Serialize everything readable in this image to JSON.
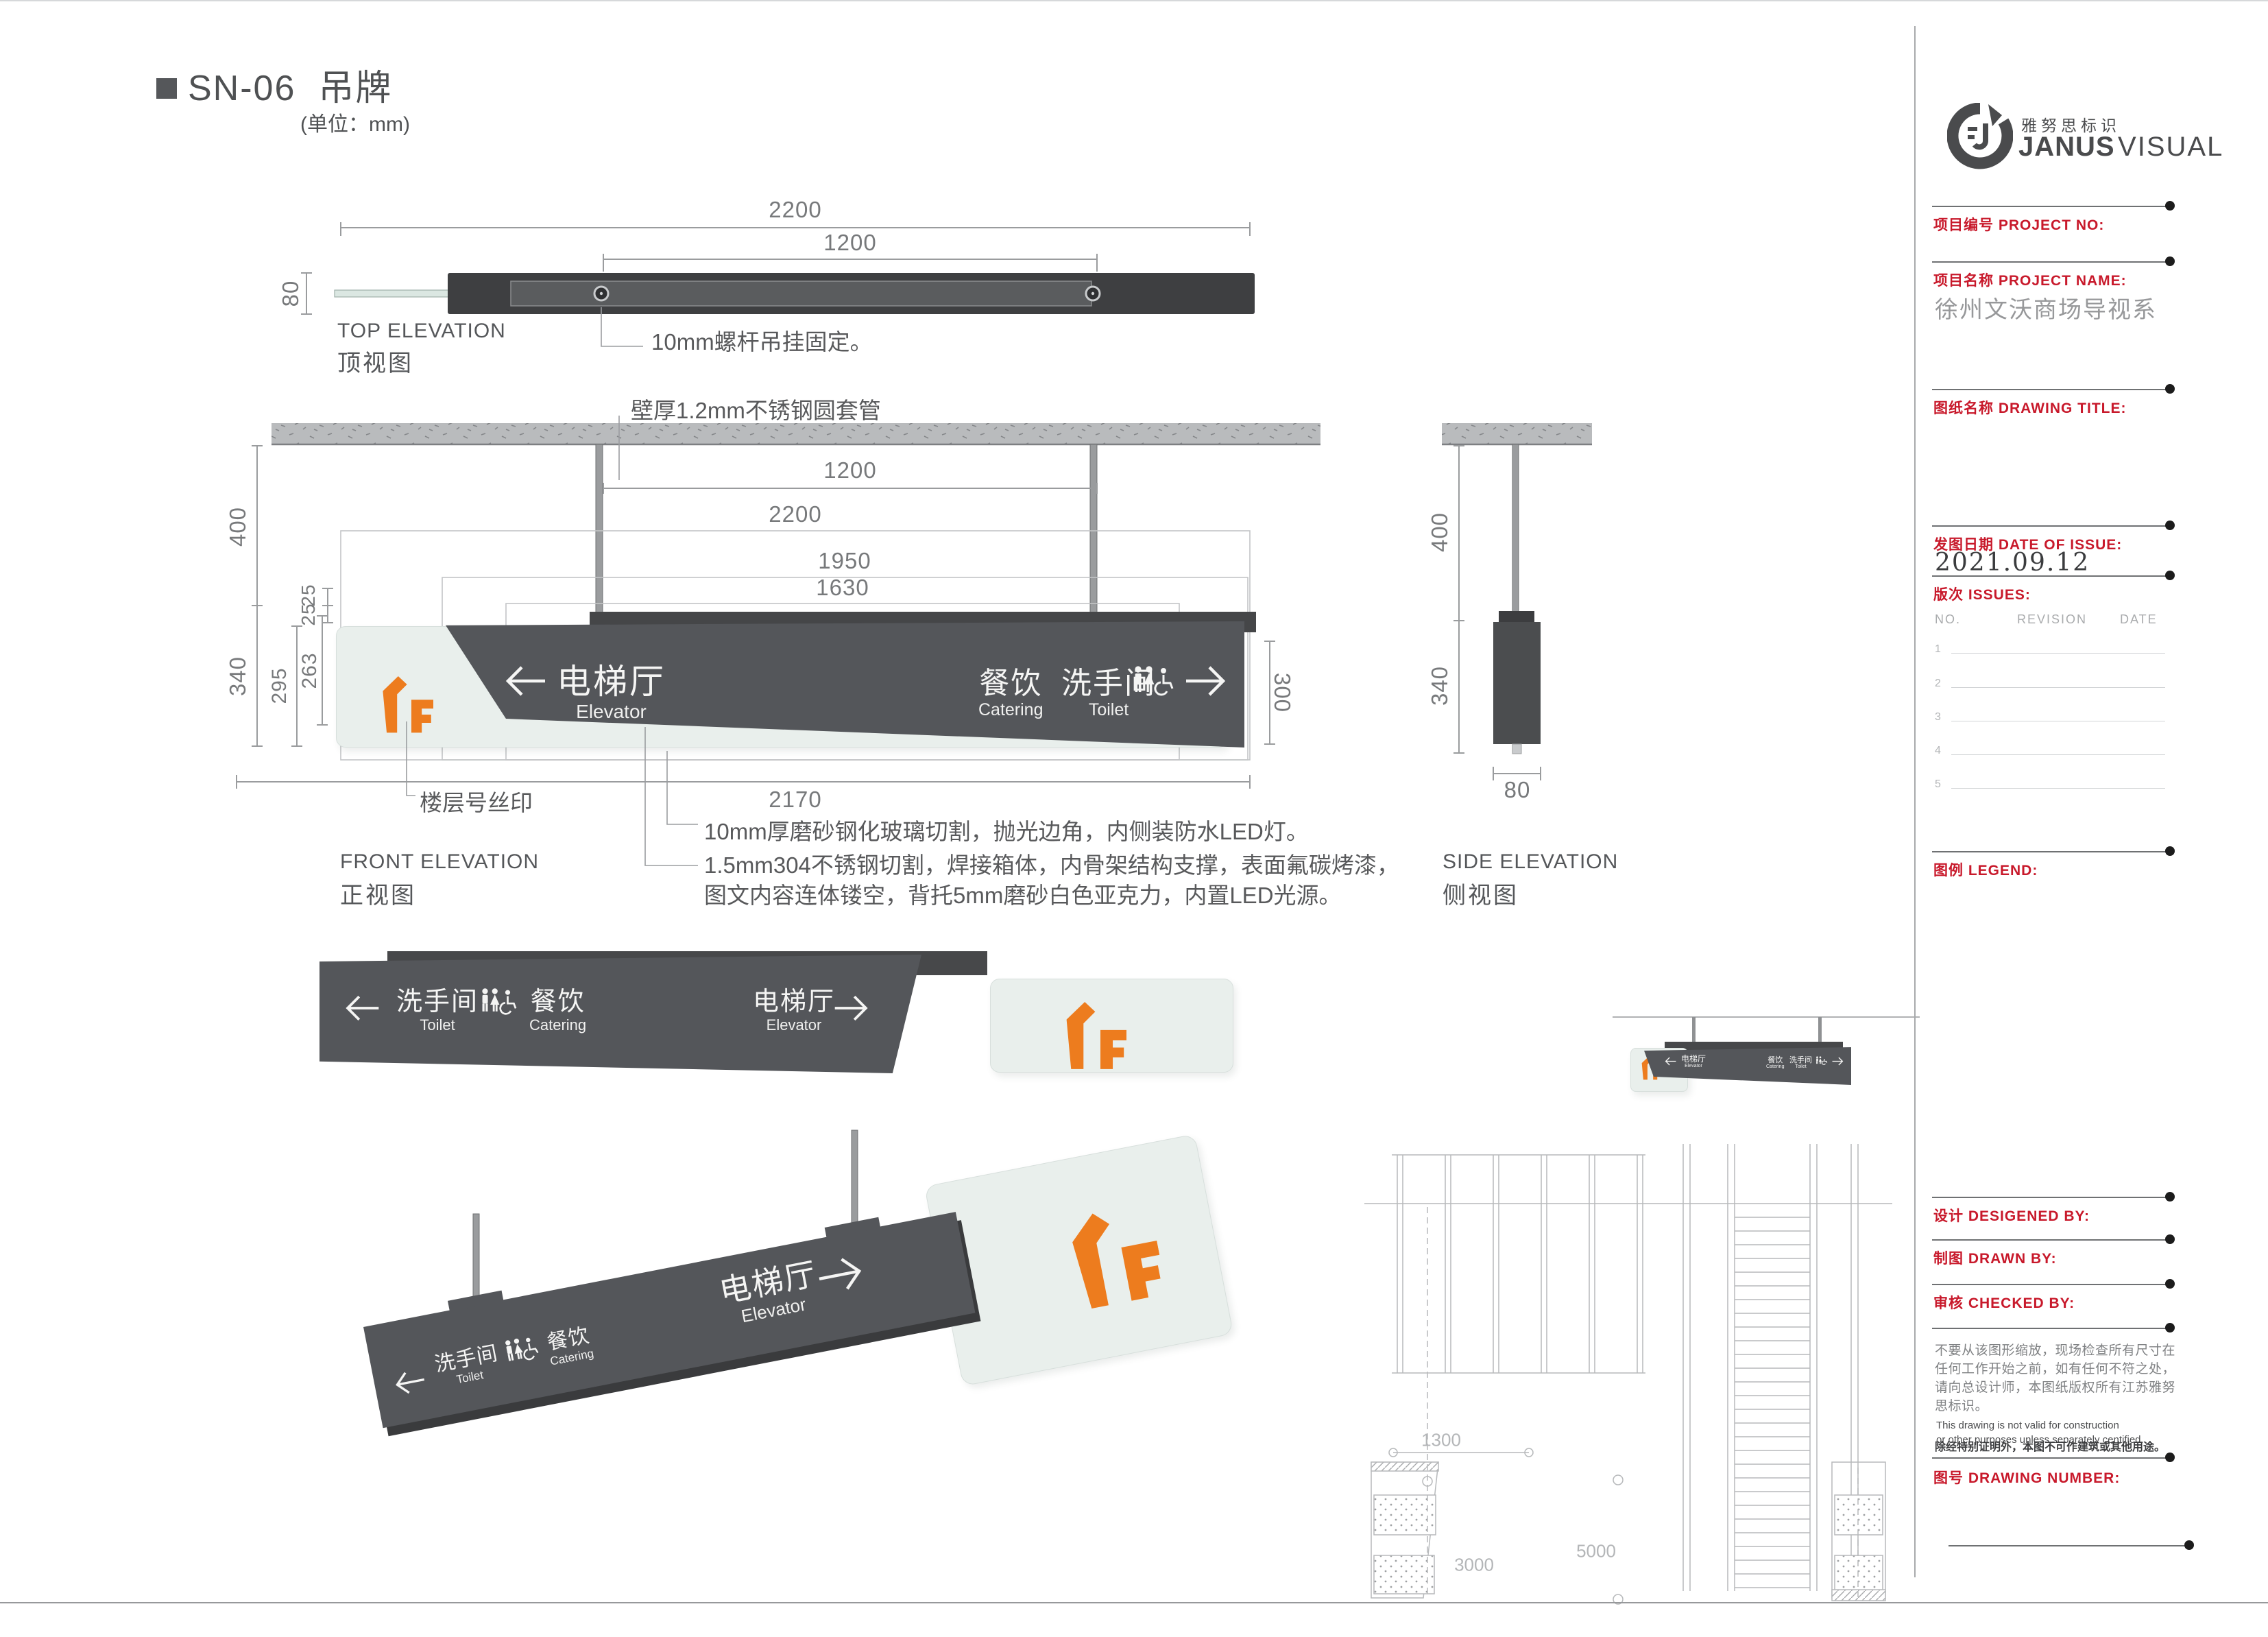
{
  "page": {
    "title_code": "SN-06",
    "title_name": "吊牌",
    "unit_note": "(单位：mm)"
  },
  "colors": {
    "plate_dark": "#54565a",
    "plate_back": "#454648",
    "glass_green": "#e9efec",
    "accent_orange": "#ed7c1e",
    "label_red": "#c8192b",
    "line_gray": "#9a9c9e"
  },
  "views": {
    "top": {
      "label_en": "TOP ELEVATION",
      "label_cn": "顶视图",
      "dims": {
        "w_outer": "2200",
        "w_inner": "1200",
        "h": "80"
      },
      "callout_bolt": "10mm螺杆吊挂固定。"
    },
    "front": {
      "label_en": "FRONT ELEVATION",
      "label_cn": "正视图",
      "dims": {
        "rod_span": "1200",
        "w1": "2200",
        "w2": "1950",
        "w3": "1630",
        "drop": "400",
        "box_h": "340",
        "glass_h": "295",
        "panel_h": "263",
        "gap1": "25",
        "gap2": "25",
        "right_h": "300",
        "bottom_w": "2170"
      },
      "callouts": {
        "pipe": "壁厚1.2mm不锈钢圆套管",
        "floor": "楼层号丝印",
        "glass": "10mm厚磨砂钢化玻璃切割，抛光边角，内侧装防水LED灯。",
        "steel_1": "1.5mm304不锈钢切割，焊接箱体，内骨架结构支撑，表面氟碳烤漆，",
        "steel_2": "图文内容连体镂空，背托5mm磨砂白色亚克力，内置LED光源。"
      }
    },
    "side": {
      "label_en": "SIDE ELEVATION",
      "label_cn": "侧视图",
      "dims": {
        "drop": "400",
        "h": "340",
        "w": "80"
      }
    },
    "context_plan": {
      "dims": {
        "d1": "1300",
        "d2": "3000",
        "d3": "5000"
      }
    }
  },
  "sign": {
    "floor": "1F",
    "elevator": {
      "cn": "电梯厅",
      "en": "Elevator"
    },
    "catering": {
      "cn": "餐饮",
      "en": "Catering"
    },
    "toilet": {
      "cn": "洗手间",
      "en": "Toilet"
    }
  },
  "sidebar": {
    "brand": {
      "cn": "雅努思标识",
      "en_bold": "JANUS",
      "en_light": "VISUAL"
    },
    "fields": {
      "project_no": "项目编号  PROJECT NO:",
      "project_name": "项目名称  PROJECT NAME:",
      "project_name_value": "徐州文沃商场导视系",
      "drawing_title": "图纸名称  DRAWING TITLE:",
      "date_of_issue": "发图日期  DATE OF ISSUE:",
      "date_value": "2021.09.12",
      "issues": "版次  ISSUES:",
      "legend": "图例  LEGEND:",
      "designed_by": "设计  DESIGENED BY:",
      "drawn_by": "制图  DRAWN BY:",
      "checked_by": "审核  CHECKED BY:",
      "drawing_number": "图号  DRAWING NUMBER:"
    },
    "issues_table": {
      "headers": [
        "NO.",
        "REVISION",
        "DATE"
      ],
      "rows": [
        "1",
        "2",
        "3",
        "4",
        "5"
      ]
    },
    "notes": {
      "cn1": "不要从该图形缩放，现场检查所有尺寸在",
      "cn2": "任何工作开始之前，如有任何不符之处，",
      "cn3": "请向总设计师，本图纸版权所有江苏雅努",
      "cn4": "思标识。",
      "en1": "This drawing is not valid for construction",
      "en2": "or other purposes unless separately centified.",
      "cn_bold": "除经特别证明外，本图不可作建筑或其他用途。"
    }
  }
}
